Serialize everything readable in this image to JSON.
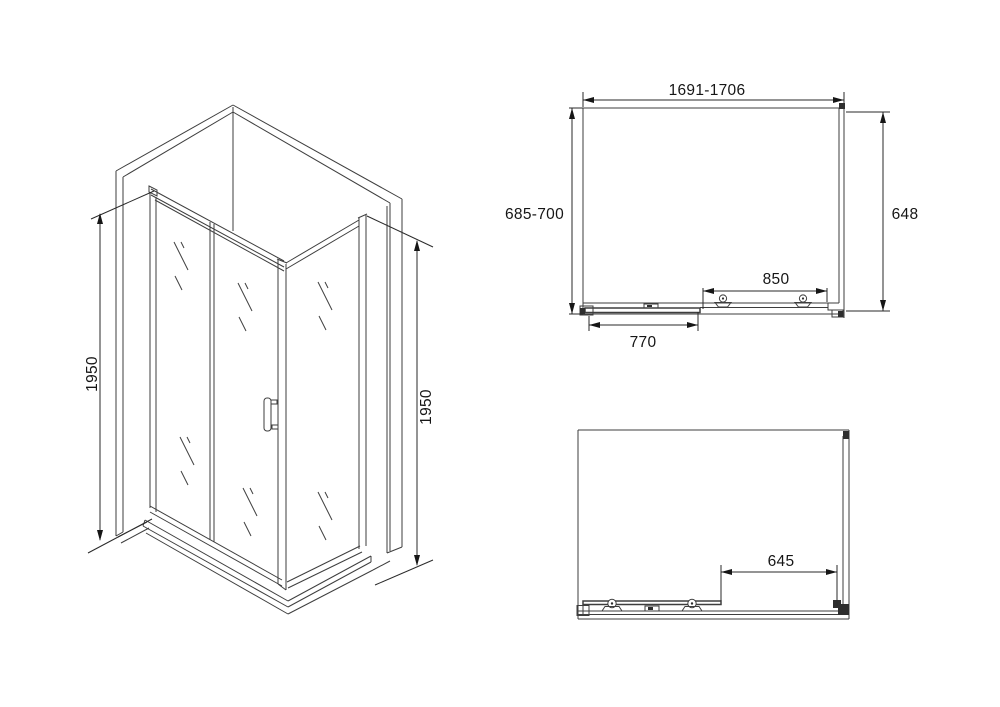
{
  "colors": {
    "background": "#ffffff",
    "line": "#3e3e3e",
    "text": "#161616"
  },
  "isometric_view": {
    "description": "corner shower enclosure with sliding door",
    "height_left_mm": "1950",
    "height_right_mm": "1950"
  },
  "top_view": {
    "overall_width_mm": "1691-1706",
    "overall_depth_mm": "685-700",
    "side_panel_mm": "648",
    "bracket_span_mm": "850",
    "door_panel_mm": "770"
  },
  "front_view": {
    "opening_width_mm": "645"
  }
}
